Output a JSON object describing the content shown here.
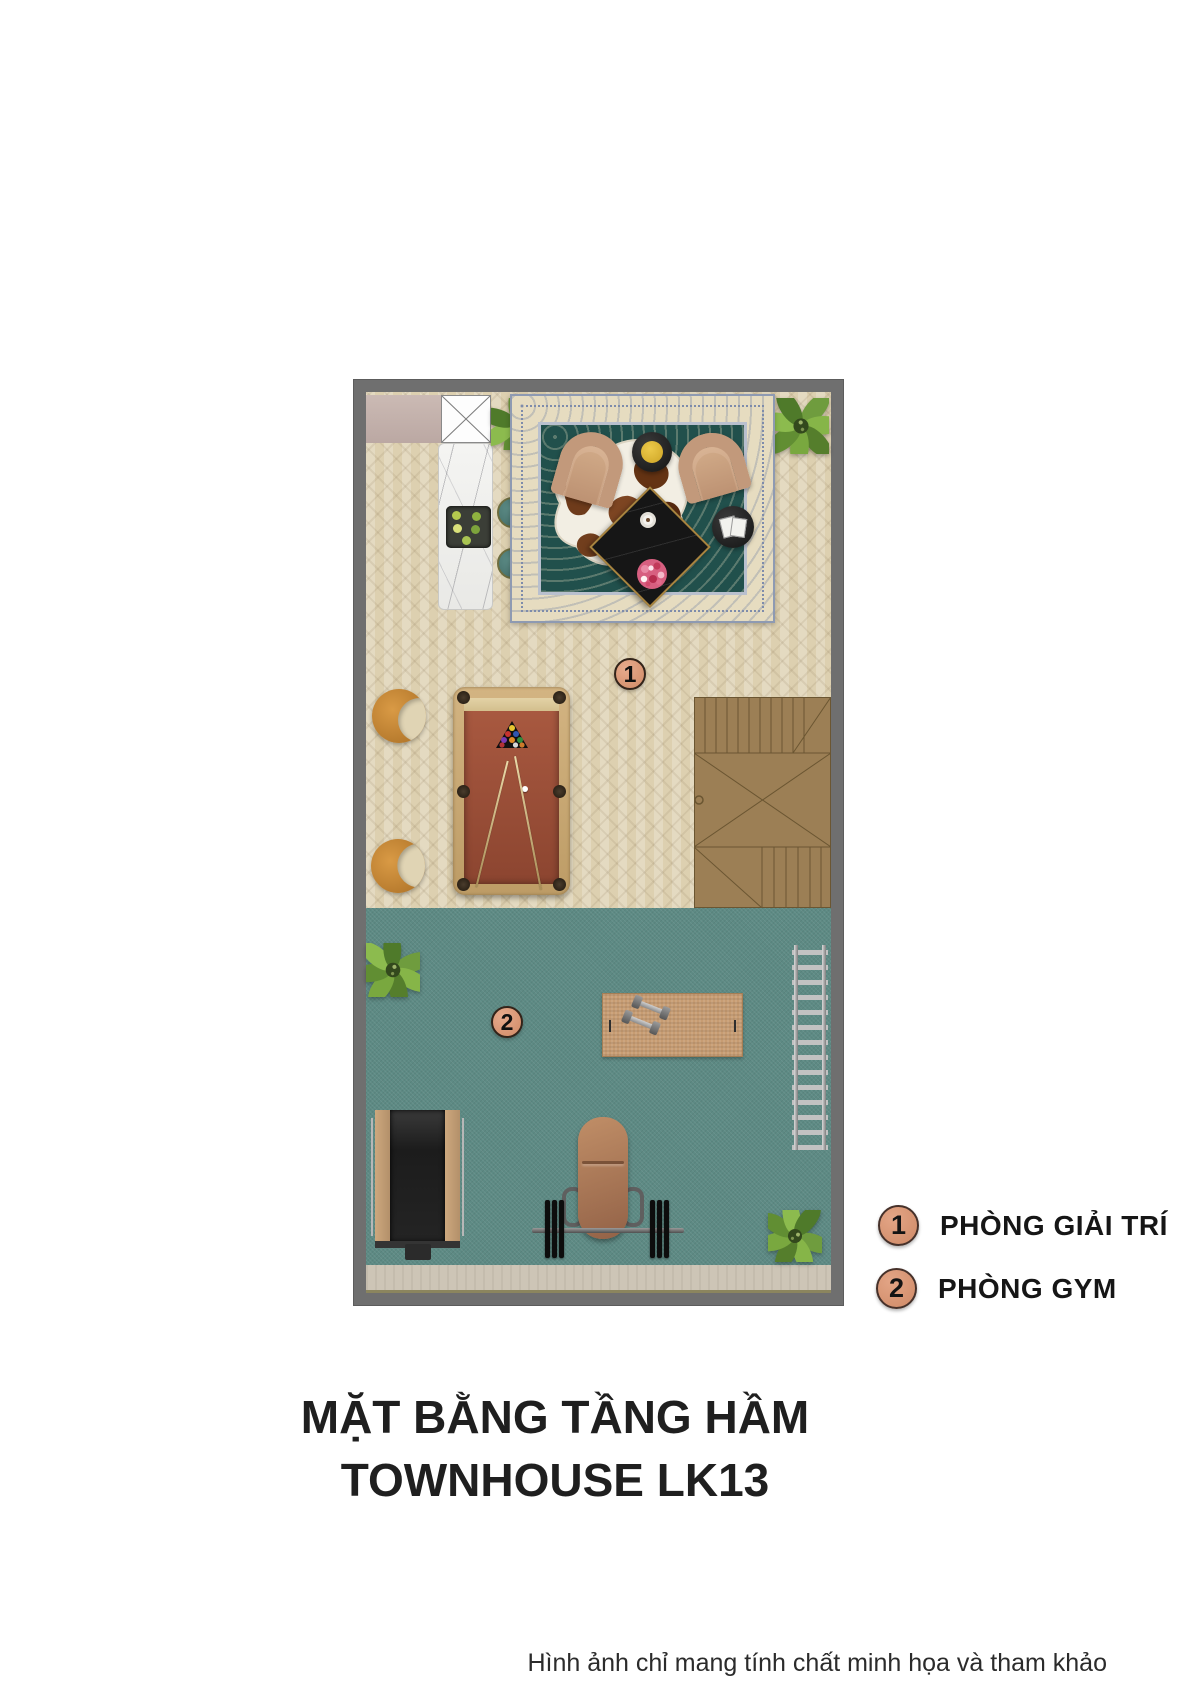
{
  "plan": {
    "markers": [
      {
        "number": "1",
        "room": "PHÒNG GIẢI TRÍ"
      },
      {
        "number": "2",
        "room": "PHÒNG GYM"
      }
    ]
  },
  "legend": {
    "items": [
      {
        "number": "1",
        "label": "PHÒNG GIẢI TRÍ"
      },
      {
        "number": "2",
        "label": "PHÒNG GYM"
      }
    ]
  },
  "title": {
    "line1": "MẶT BẰNG TẦNG HẦM",
    "line2": "TOWNHOUSE LK13"
  },
  "footnote": "Hình ảnh chỉ mang tính chất minh họa và tham khảo",
  "colors": {
    "wall": "#6f6f6f",
    "wood_floor": "#ddd0b0",
    "gym_floor": "#5d8a84",
    "marker": "#d9987b",
    "stairs": "#9c7f55",
    "rug_border": "#e6dcc0",
    "rug_field": "#21504c",
    "pool_felt": "#a3543c",
    "marble": "#f2f2f0",
    "bench_leather": "#a9754f"
  }
}
